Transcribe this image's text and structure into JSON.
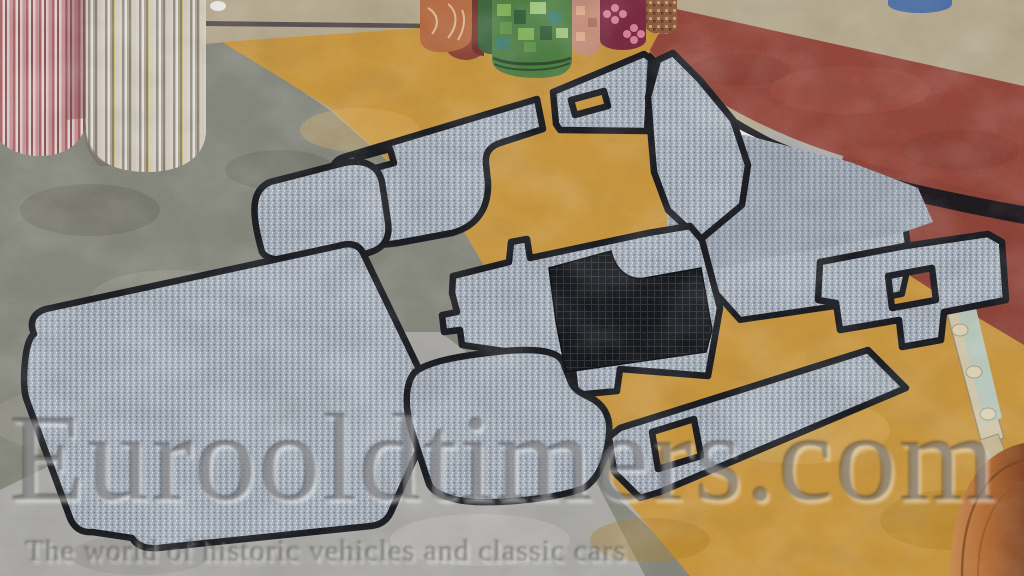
{
  "watermark": {
    "title": "Eurooldtimers.com",
    "subtitle": "The world of historic vehicles and classic cars"
  },
  "palette": {
    "carpet_gray": "#9fa8b3",
    "carpet_unbound": "#99a1ad",
    "carpet_binding": "#191b20",
    "heel_pad_black": "#15161a",
    "floor_gold": "#c4933d",
    "floor_red": "#8a4136",
    "red_sheet": "#91453a",
    "floor_gray_green": "#83847a",
    "floor_light_gray": "#a7a6a2",
    "floor_tan": "#b2a68c",
    "roll_stripe_red": "#a95f63",
    "roll_stripe_beige": "#cfc8bb",
    "roll_green": "#4d7c42",
    "roll_orange": "#b0673e",
    "roll_maroon": "#8c4336",
    "roll_salmon": "#c08a76",
    "roll_burgundy": "#76293f",
    "roll_brown": "#8a5a3e",
    "roll_blue": "#4c6ea3",
    "wood_rack": "#cfc3a8",
    "wood_column": "#b97845"
  },
  "scene": {
    "objects": [
      "striped fabric rolls",
      "patterned carpet rolls",
      "grey car carpet set with black binding",
      "black rubber heel pad",
      "unbound grey carpet piece",
      "curved red linoleum sheet",
      "gold linoleum floor",
      "wooden display rack",
      "wooden column"
    ]
  }
}
